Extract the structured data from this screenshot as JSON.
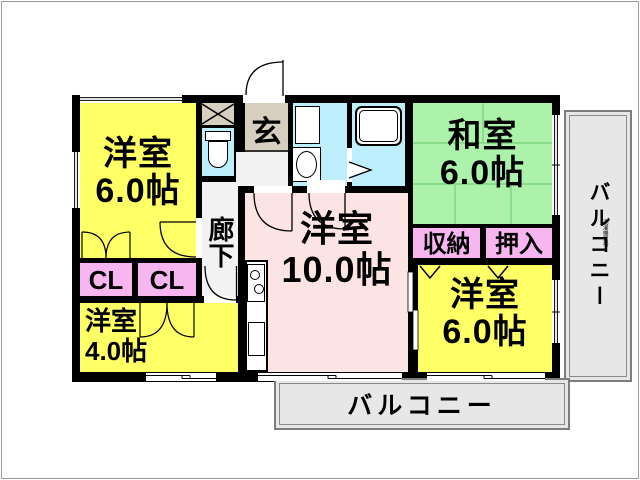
{
  "colors": {
    "wall": "#000000",
    "yellow_room": "#FFFF66",
    "green_room": "#ADF2AB",
    "pink_room": "#FBE4E3",
    "closet_pink": "#F8B6F0",
    "water_blue": "#BDEEFB",
    "beige": "#D6CFC0",
    "hall_gray": "#F2F2F2",
    "balcony_gray": "#E7E7E7",
    "tatami_line": "#7FD87F"
  },
  "rooms": {
    "west_top_left": {
      "name": "洋室",
      "area": "6.0帖"
    },
    "japanese": {
      "name": "和室",
      "area": "6.0帖"
    },
    "living": {
      "name": "洋室",
      "area": "10.0帖"
    },
    "west_bottom_left": {
      "name": "洋室",
      "area": "4.0帖"
    },
    "west_bottom_right": {
      "name": "洋室",
      "area": "6.0帖"
    }
  },
  "labels": {
    "genkan": "玄",
    "corridor": "廊下",
    "closet_left": "CL",
    "closet_right": "CL",
    "shunou": "収納",
    "oshiire": "押入",
    "balcony_right": "バルコニー",
    "balcony_bottom": "バルコニー",
    "laundry": "洗濯機置場"
  }
}
